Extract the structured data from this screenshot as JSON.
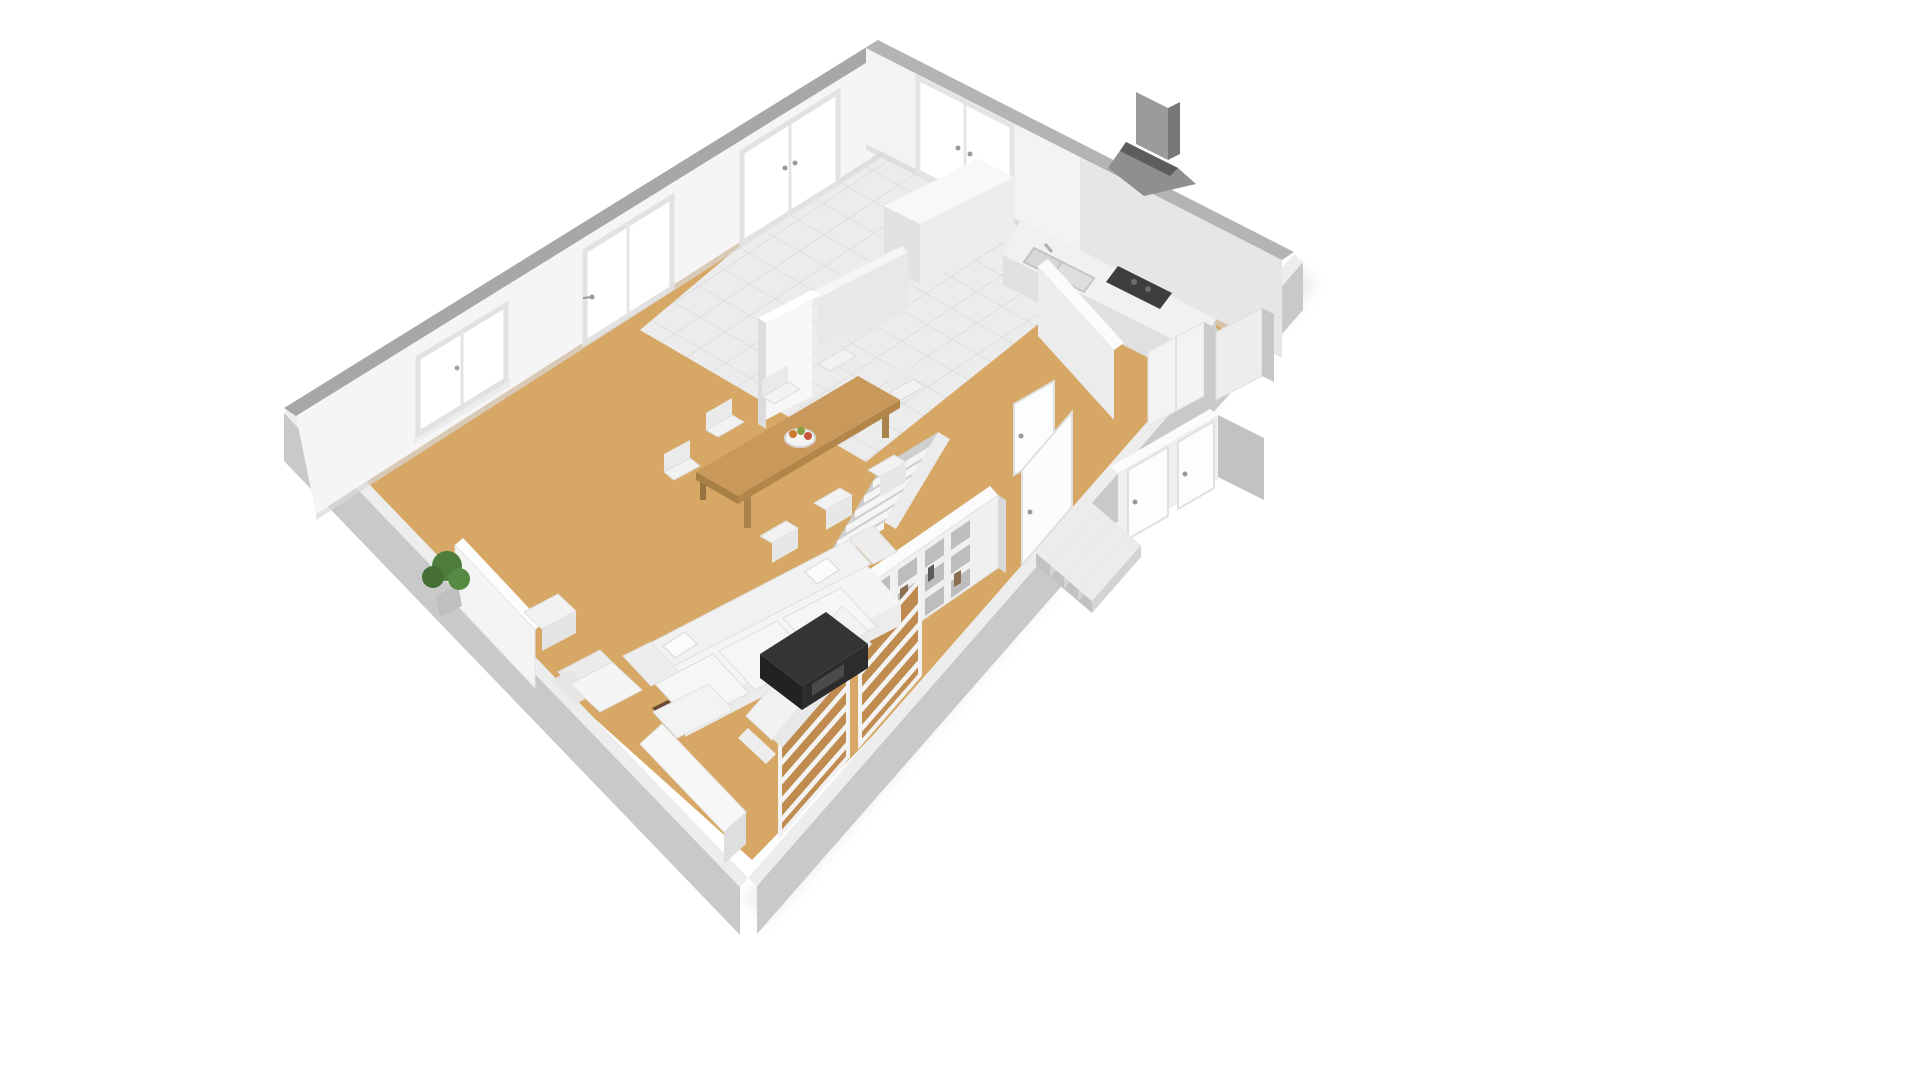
{
  "scene": {
    "kind": "isometric-3d-floorplan-render",
    "view": "axonometric top-down, rotated diamond orientation",
    "background": "#ffffff",
    "rooms": [
      "kitchen",
      "dining-area",
      "living-room",
      "hallway",
      "bedroom-wing",
      "entry"
    ],
    "objects": [
      "perimeter-walls",
      "window",
      "glass-doors",
      "kitchen-tile-floor",
      "range-hood",
      "kitchen-counter",
      "sink",
      "cooktop",
      "kitchen-island",
      "dining-table",
      "dining-chairs",
      "fruit-bowl",
      "bookshelf",
      "staircase",
      "sofa",
      "small-sofa",
      "armchair",
      "coffee-table",
      "tv-bench",
      "side-table",
      "sideboard-panel",
      "potted-plant",
      "window-shutters",
      "interior-walls",
      "interior-doors",
      "wardrobes",
      "entry-door",
      "entry-steps"
    ],
    "counts": {
      "dining_chairs": 8,
      "sofas": 2,
      "entry_steps": 4,
      "shutter_panels": 2,
      "bookshelf_columns": 4,
      "bookshelf_rows": 3,
      "top_left_wall_openings": 3,
      "top_right_wall_openings": 1
    }
  },
  "palette": {
    "background": "#ffffff",
    "floor_tan": "#d6a765",
    "tile": "#ececec",
    "tile_line": "#d8d8d8",
    "wall_white": "#f5f5f5",
    "wall_cap": "#a7a7a7",
    "wall_cap_right": "#b4b4b4",
    "outer_wall": "#c9c9c9",
    "bottom_cap": "#ededed",
    "inner_wall_side": "#c2c2c2",
    "wood": "#c9995c",
    "wood_edge": "#b28549",
    "white_furniture": "#f4f4f4",
    "furniture_shade": "#dcdcdc",
    "appliance_dark": "#3d3d3d",
    "hood_gray": "#9b9b9b",
    "coffee_table": "#343434",
    "plant_green": "#4e7d3c",
    "shutter_wood": "#c08b4e",
    "shadow": "#8a8a8a"
  }
}
